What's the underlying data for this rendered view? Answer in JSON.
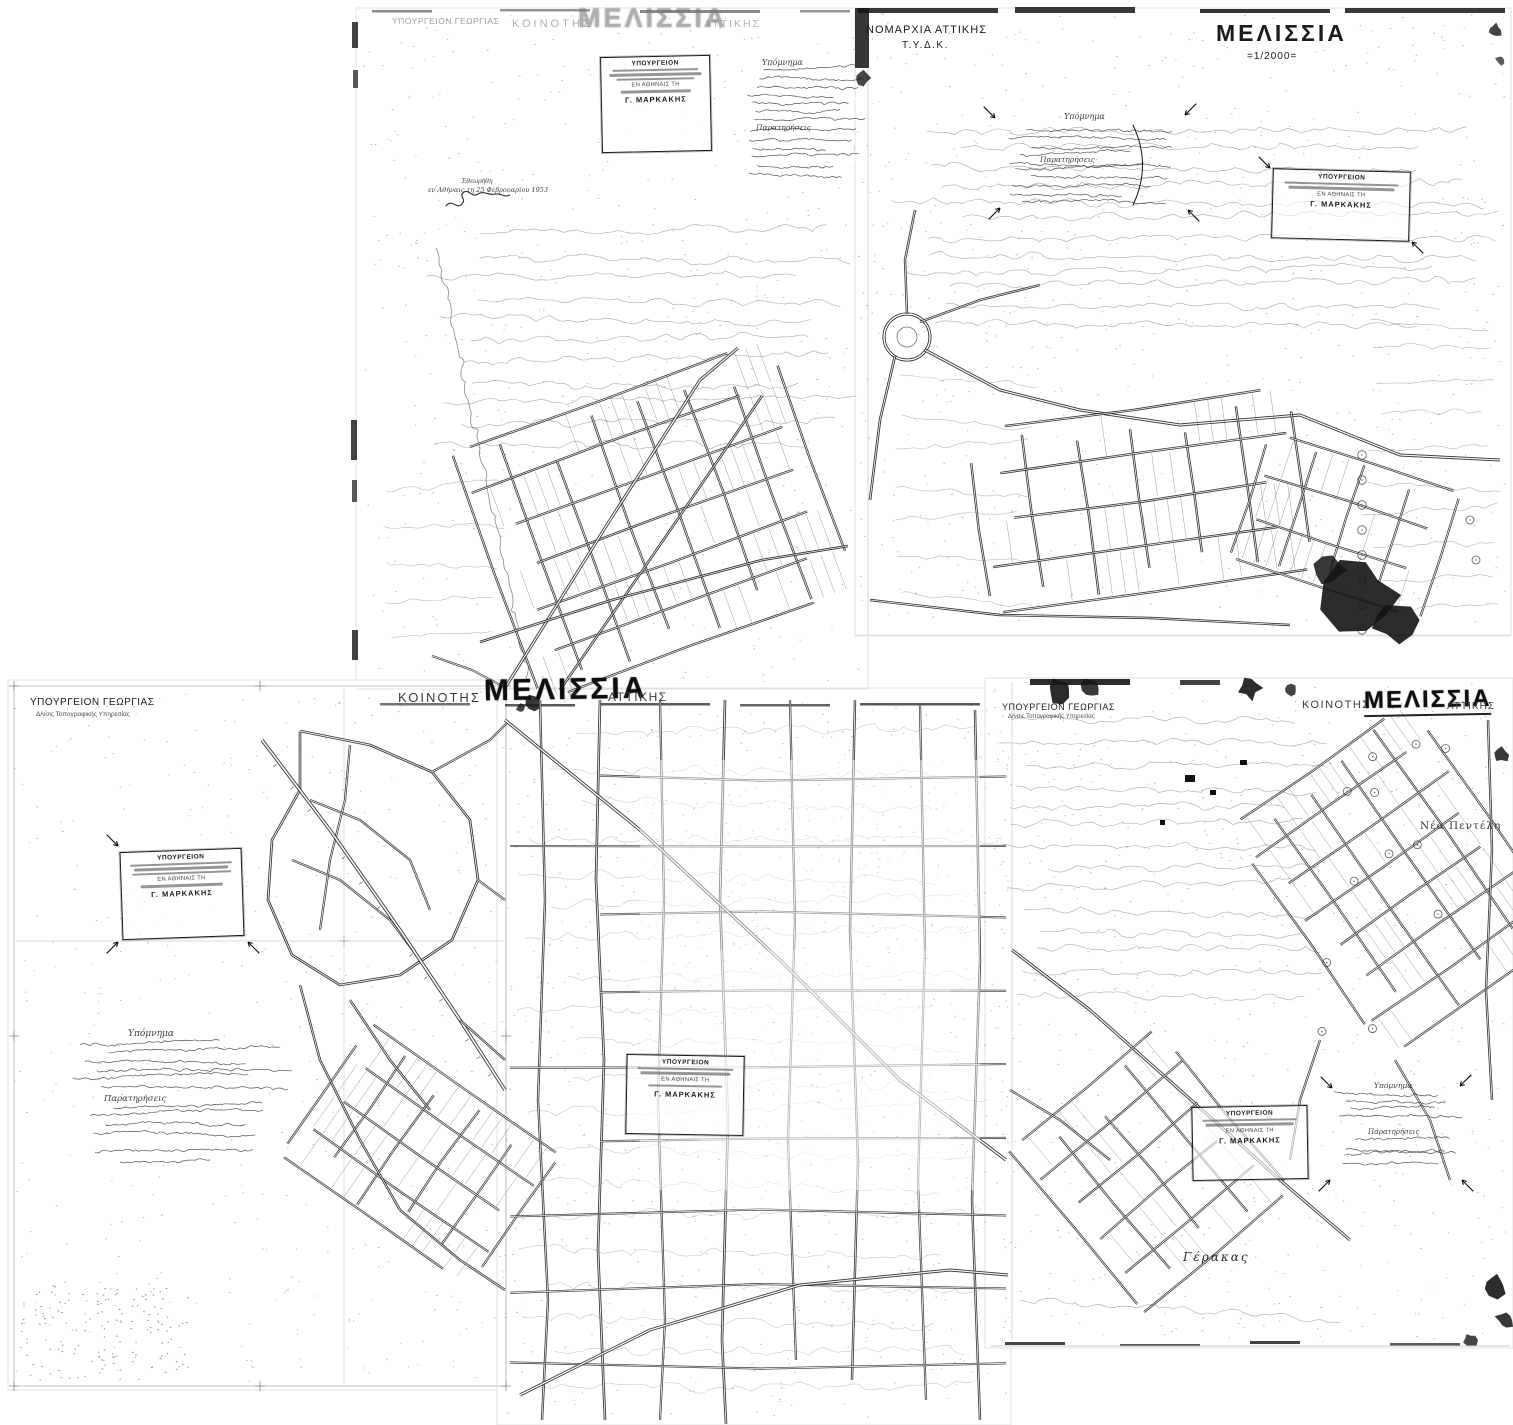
{
  "colors": {
    "ink": "#1b1b1b",
    "paper": "#ffffff",
    "contour": "#555555"
  },
  "sheet_top_left": {
    "faded_header": {
      "ministry": "ΥΠΟΥΡΓΕΙΟΝ ΓΕΩΡΓΙΑΣ",
      "community": "ΚΟΙΝΟΤΗΣ",
      "title": "ΜΕΛΙΣΣΙΑ",
      "region": "ΑΤΤΙΚΗΣ"
    },
    "stamp": {
      "header": "ΥΠΟΥΡΓΕΙΟΝ",
      "date_line": "ΕΝ ΑΘΗΝΑΙΣ ΤΗ",
      "signature": "Γ. ΜΑΡΚΑΚΗΣ"
    },
    "legend": {
      "heading": "Υπόμνημα",
      "remarks": "Παρατηρήσεις"
    },
    "review_note": {
      "line1": "Εθεωρήθη",
      "line2": "εν Αθήναις τη 25 Φεβρουαρίου 1953"
    }
  },
  "sheet_top_right": {
    "agency": "ΝΟΜΑΡΧΙΑ ΑΤΤΙΚΗΣ",
    "agency_dept": "Τ.Υ.Δ.Κ.",
    "title": "ΜΕΛΙΣΣΙΑ",
    "scale": "=1/2000=",
    "legend": {
      "heading": "Υπόμνημα",
      "remarks": "Παρατηρήσεις"
    },
    "stamp": {
      "header": "ΥΠΟΥΡΓΕΙΟΝ",
      "date_line": "ΕΝ ΑΘΗΝΑΙΣ ΤΗ",
      "signature": "Γ. ΜΑΡΚΑΚΗΣ"
    }
  },
  "sheet_bottom_left": {
    "ministry": "ΥΠΟΥΡΓΕΙΟΝ ΓΕΩΡΓΙΑΣ",
    "ministry_dept": "Δ/νσις Τοπογραφικής Υπηρεσίας",
    "stamp": {
      "header": "ΥΠΟΥΡΓΕΙΟΝ",
      "date_line": "ΕΝ ΑΘΗΝΑΙΣ ΤΗ",
      "signature": "Γ. ΜΑΡΚΑΚΗΣ"
    },
    "notes": {
      "heading": "Υπόμνημα",
      "remarks": "Παρατηρήσεις"
    }
  },
  "sheet_bottom_center": {
    "header": {
      "community": "ΚΟΙΝΟΤΗΣ",
      "title": "ΜΕΛΙΣΣΙΑ",
      "region": "ΑΤΤΙΚΗΣ"
    },
    "stamp": {
      "header": "ΥΠΟΥΡΓΕΙΟΝ",
      "date_line": "ΕΝ ΑΘΗΝΑΙΣ ΤΗ",
      "signature": "Γ. ΜΑΡΚΑΚΗΣ"
    }
  },
  "sheet_bottom_right": {
    "ministry": "ΥΠΟΥΡΓΕΙΟΝ ΓΕΩΡΓΙΑΣ",
    "ministry_dept": "Δ/νσις Τοπογραφικής Υπηρεσίας",
    "header": {
      "community": "ΚΟΙΝΟΤΗΣ",
      "title": "ΜΕΛΙΣΣΙΑ",
      "region": "ΑΤΤΙΚΗΣ"
    },
    "labels": {
      "nea_penteli": "Νέα Πεντέλη",
      "gerakas": "Γέρακας"
    },
    "legend": {
      "heading": "Υπόμνημα",
      "remarks": "Παρατηρήσεις"
    },
    "stamp": {
      "header": "ΥΠΟΥΡΓΕΙΟΝ",
      "date_line": "ΕΝ ΑΘΗΝΑΙΣ ΤΗ",
      "signature": "Γ. ΜΑΡΚΑΚΗΣ"
    }
  }
}
